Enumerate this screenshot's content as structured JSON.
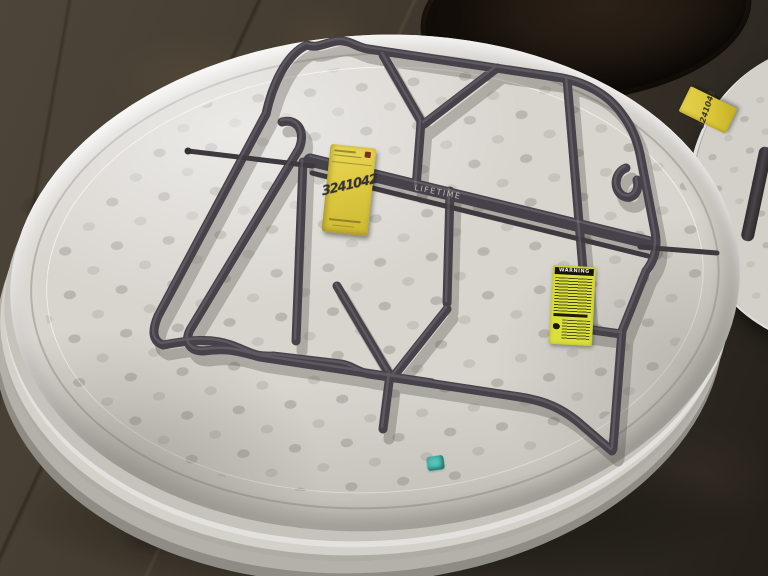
{
  "labels": {
    "brand": "LIFETIME",
    "warning_title": "WARNING"
  },
  "tags": {
    "main_tag_number": "3241042",
    "adjacent_tag_number": "3241043"
  },
  "colors": {
    "floor_brown": "#3f372d",
    "tabletop_white": "#d8d5cf",
    "frame_gray": "#47424a",
    "auction_tag_yellow": "#e0cb44",
    "warning_label_yellow": "#dce03d",
    "sticker_teal": "#3fa89e",
    "dark_stack_brown": "#231a12"
  }
}
